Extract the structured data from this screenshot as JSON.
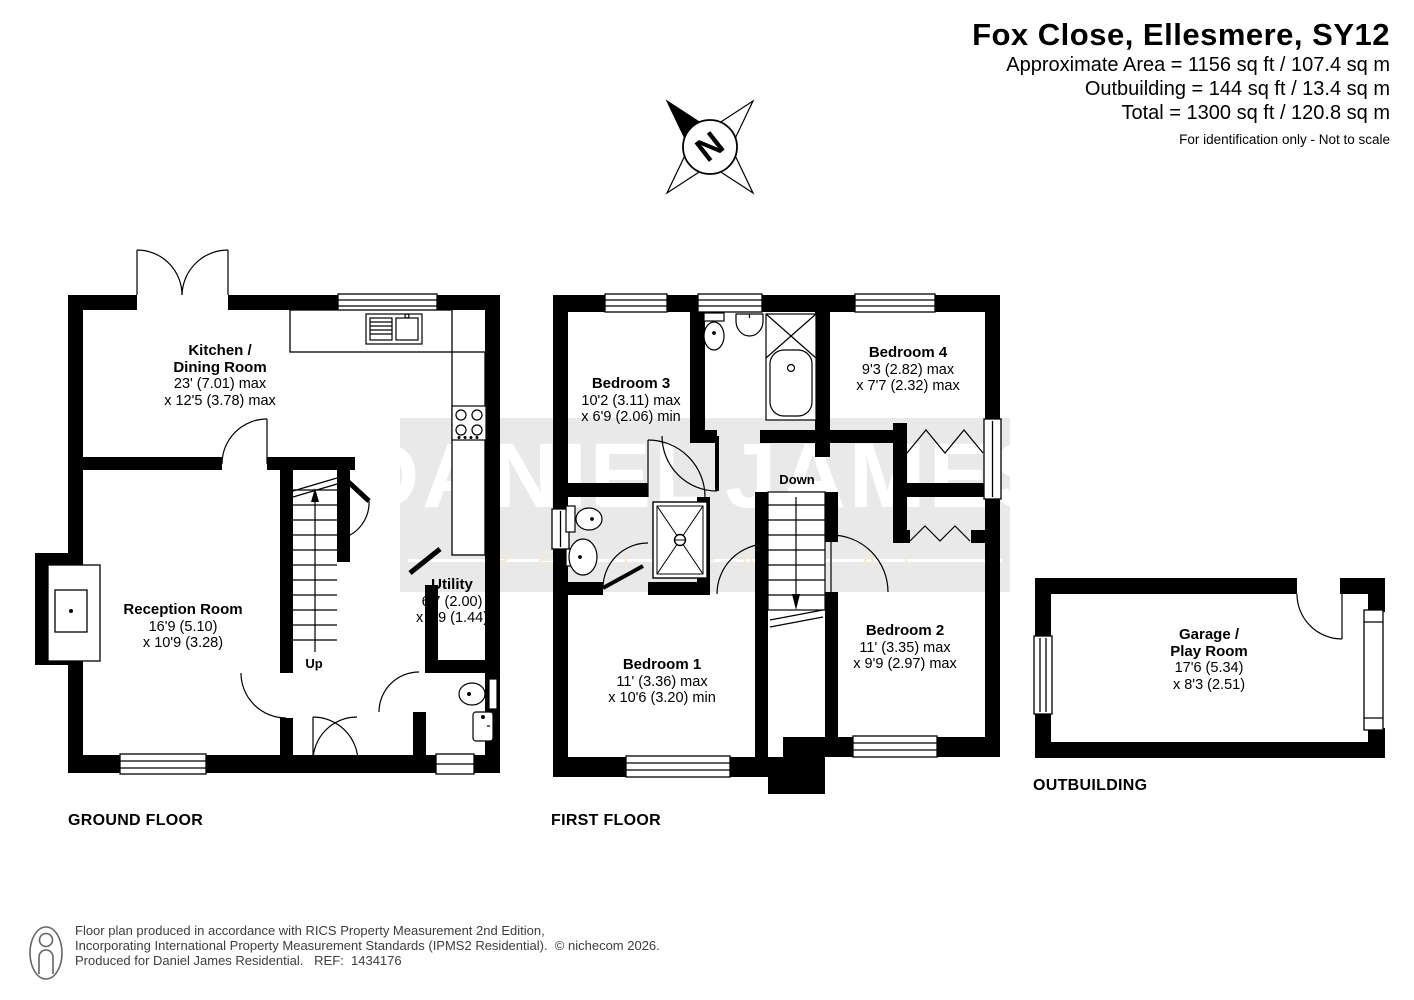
{
  "header": {
    "title": "Fox Close, Ellesmere, SY12",
    "line1": "Approximate Area = 1156 sq ft / 107.4 sq m",
    "line2": "Outbuilding = 144 sq ft / 13.4 sq m",
    "line3": "Total = 1300 sq ft / 120.8 sq m",
    "note": "For identification only - Not to scale"
  },
  "compass": {
    "north": "N"
  },
  "watermark": {
    "word1": "DANIEL",
    "word2": "JAMES",
    "tagline": "RESIDENTIAL",
    "key_color": "#d0a95e",
    "band_color": "#e8e8e8"
  },
  "ground_floor": {
    "label": "GROUND FLOOR",
    "stairs": "Up",
    "kitchen": {
      "name1": "Kitchen /",
      "name2": "Dining Room",
      "dim1": "23' (7.01) max",
      "dim2": "x 12'5 (3.78) max"
    },
    "reception": {
      "name1": "Reception Room",
      "dim1": "16'9 (5.10)",
      "dim2": "x 10'9 (3.28)"
    },
    "utility": {
      "name1": "Utility",
      "dim1": "6'7 (2.00)",
      "dim2": "x 4'9 (1.44)"
    }
  },
  "first_floor": {
    "label": "FIRST FLOOR",
    "stairs": "Down",
    "bedroom1": {
      "name1": "Bedroom 1",
      "dim1": "11' (3.36) max",
      "dim2": "x 10'6 (3.20) min"
    },
    "bedroom2": {
      "name1": "Bedroom 2",
      "dim1": "11' (3.35) max",
      "dim2": "x 9'9 (2.97) max"
    },
    "bedroom3": {
      "name1": "Bedroom 3",
      "dim1": "10'2 (3.11) max",
      "dim2": "x 6'9 (2.06) min"
    },
    "bedroom4": {
      "name1": "Bedroom 4",
      "dim1": "9'3 (2.82) max",
      "dim2": "x 7'7 (2.32) max"
    }
  },
  "outbuilding": {
    "label": "OUTBUILDING",
    "garage": {
      "name1": "Garage /",
      "name2": "Play Room",
      "dim1": "17'6 (5.34)",
      "dim2": "x 8'3 (2.51)"
    }
  },
  "footer": {
    "line1": "Floor plan produced in accordance with RICS Property Measurement 2nd Edition,",
    "line2": "Incorporating International Property Measurement Standards (IPMS2 Residential).  © nichecom 2026.",
    "line3": "Produced for Daniel James Residential.   REF:  1434176"
  }
}
